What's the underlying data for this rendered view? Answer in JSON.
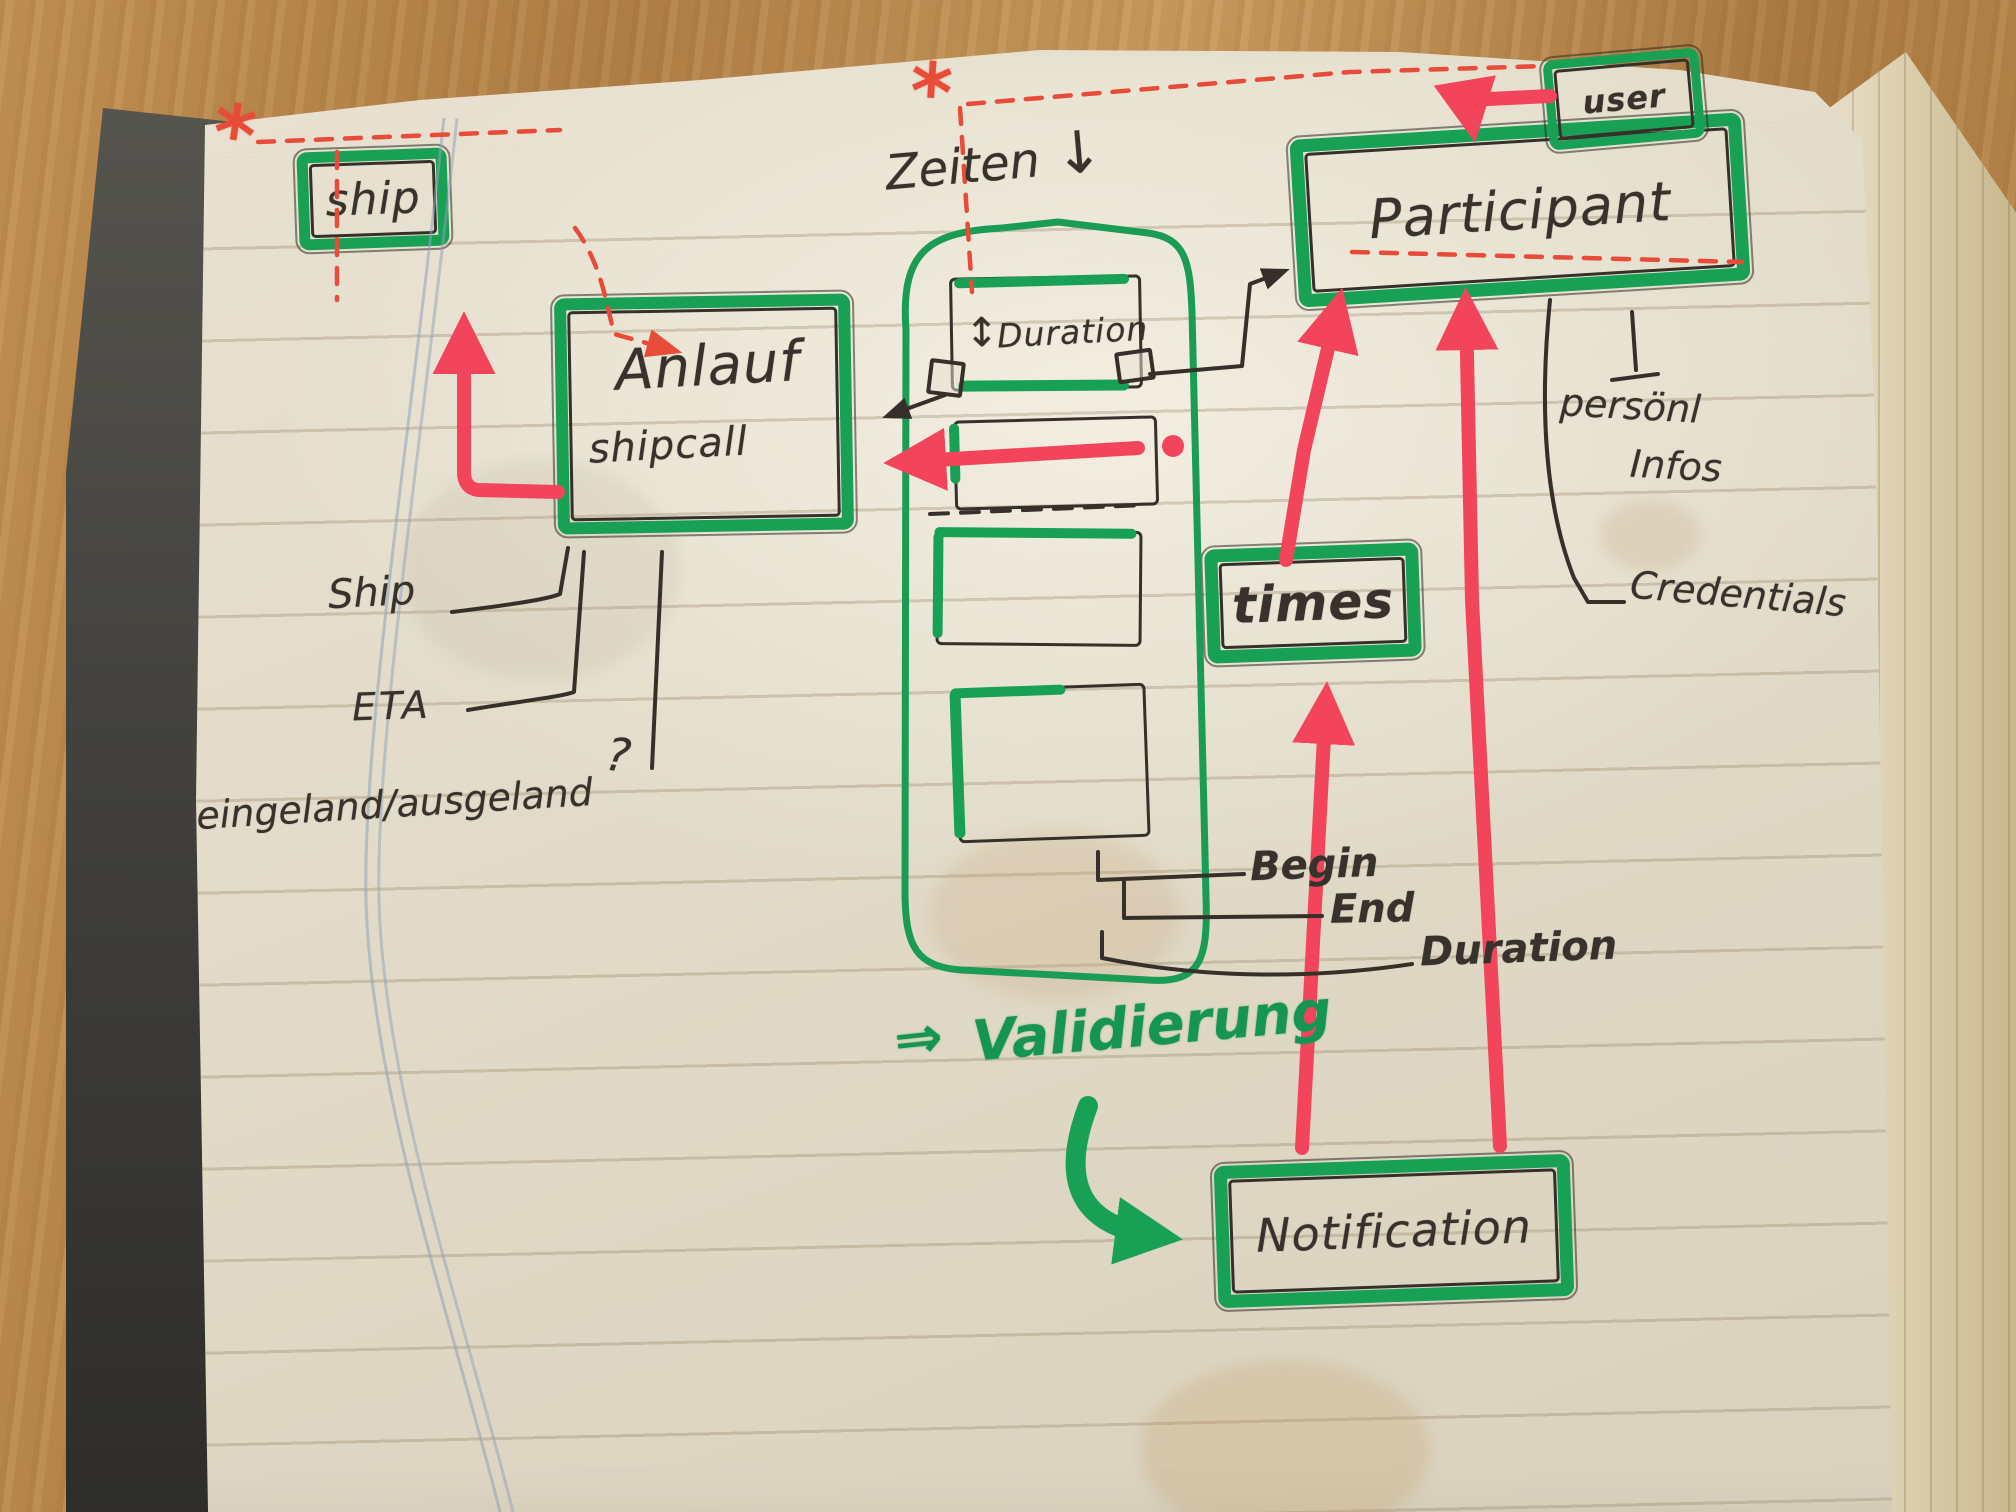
{
  "page": {
    "boxes": {
      "ship": {
        "label": "ship"
      },
      "anlauf": {
        "label": "Anlauf",
        "sublabel": "shipcall"
      },
      "duration": {
        "updown_arrow": "↕",
        "label": "Duration"
      },
      "participant": {
        "label": "Participant"
      },
      "user": {
        "label": "user"
      },
      "times": {
        "label": "times"
      },
      "notification": {
        "label": "Notification"
      }
    },
    "annotations": {
      "zeiten": "Zeiten",
      "zeiten_arrow": "↓",
      "ship_attr": "Ship",
      "eta": "ETA",
      "in_out": "eingeland/ausgeland",
      "question": "?",
      "begin": "Begin",
      "end": "End",
      "duration_attr": "Duration",
      "persoenl_line1": "persönl",
      "persoenl_line2": "Infos",
      "credentials": "Credentials",
      "validierung_arrow": "⇒",
      "validierung": "Validierung",
      "asterisk_left": "*",
      "asterisk_right": "*"
    },
    "colors": {
      "marker_green": "#18a055",
      "marker_red": "#f2455c",
      "dashed_red": "#e84b38",
      "pen_black": "#36302a",
      "margin_blue": "#8fa2b5",
      "paper": "#e2dbc9",
      "wood": "#b98a4e"
    }
  }
}
